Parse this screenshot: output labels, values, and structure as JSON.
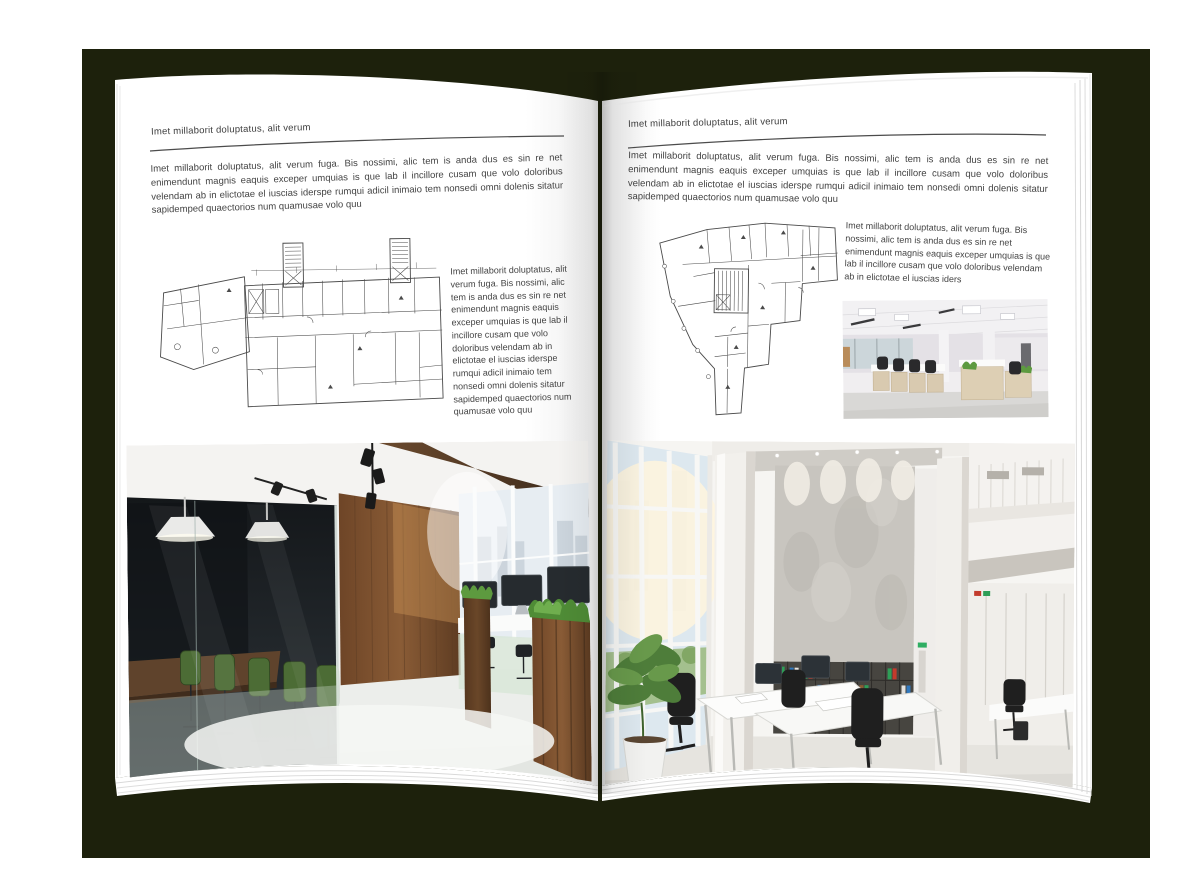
{
  "palette": {
    "backdrop": "#1d210c",
    "page": "#ffffff",
    "body_text": "#434343",
    "rule_line": "#4c4c4c",
    "plan_line": "#4a4a4a"
  },
  "left_page": {
    "header": "Imet millaborit doluptatus, alit verum",
    "intro": "Imet millaborit doluptatus, alit verum fuga. Bis nossimi, alic tem is anda dus es sin re net enimendunt magnis eaquis exceper umquias is que lab il incillore cusam que volo doloribus velendam ab in elictotae el iuscias iderspe rumqui adicil inimaio tem nonsedi omni dolenis sitatur sapidemped quaectorios num quamusae volo quu",
    "side_text": "Imet millaborit doluptatus, alit verum fuga. Bis nossimi, alic tem is anda dus es sin re net enimendunt magnis eaquis exceper umquias is que lab il incillore cusam que volo doloribus velendam ab in elictotae el iuscias iderspe rumqui adicil inimaio tem nonsedi omni dolenis sitatur sapidemped quaectorios num quamusae volo quu"
  },
  "right_page": {
    "header": "Imet millaborit doluptatus, alit verum",
    "intro": "Imet millaborit doluptatus, alit verum fuga. Bis nossimi, alic tem is anda dus es sin re net enimendunt magnis eaquis exceper umquias is que lab il incillore cusam que volo doloribus velendam ab in elictotae el iuscias iderspe rumqui adicil inimaio tem nonsedi omni dolenis sitatur sapidemped quaectorios num quamusae volo quu",
    "side_text": "Imet millaborit doluptatus, alit verum fuga. Bis nossimi, alic tem is anda dus es sin re net enimendunt magnis eaquis exceper umquias is que lab il incillore cusam que volo doloribus velendam ab in elictotae el iuscias iders"
  }
}
